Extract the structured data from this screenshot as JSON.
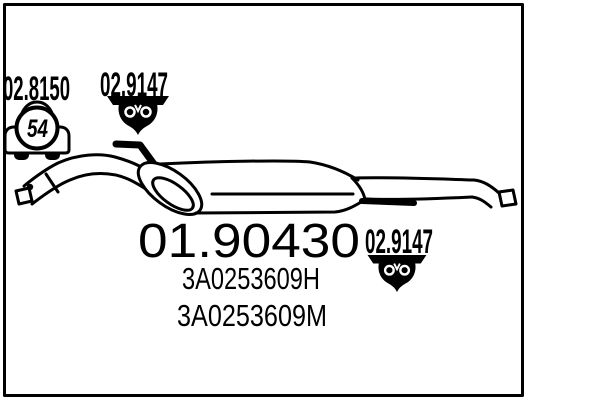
{
  "page": {
    "background_color": "#ffffff",
    "ink_color": "#000000",
    "description": "Exhaust rear silencer parts-catalog diagram"
  },
  "diagram": {
    "labels": {
      "accessory_code_left": "02.8150",
      "mount_code_top": "02.9147",
      "mount_code_bottom": "02.9147",
      "part_number": "01.90430",
      "oem_reference_1": "3A0253609H",
      "oem_reference_2": "3A0253609M",
      "car_badge_number": "54"
    },
    "icons": {
      "car_icon": "car-with-badge-icon",
      "mount_icon_top": "rubber-mount-icon",
      "mount_icon_bottom": "rubber-mount-icon"
    }
  }
}
